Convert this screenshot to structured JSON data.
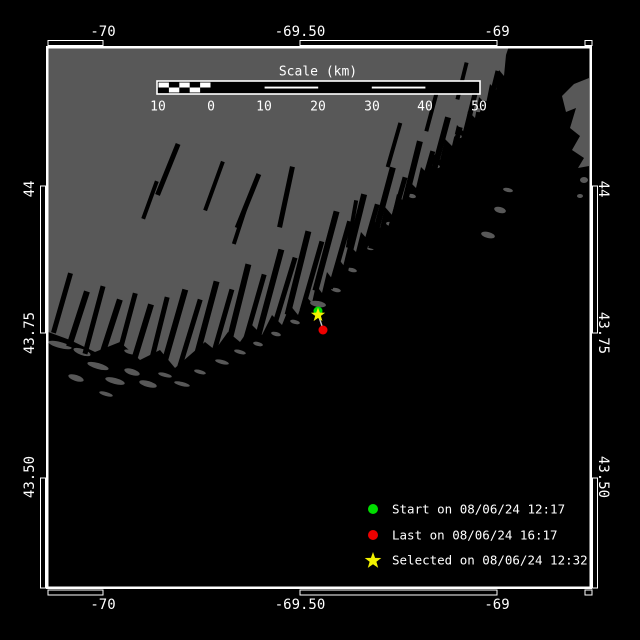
{
  "colors": {
    "background": "#000000",
    "water": "#000000",
    "land": "#585858",
    "frame": "#ffffff",
    "text": "#ffffff",
    "start_marker": "#00dd00",
    "last_marker": "#ee0000",
    "selected_marker": "#f2f200",
    "track": "#c8c8c8"
  },
  "axes": {
    "top": [
      "-70",
      "-69.50",
      "-69"
    ],
    "bottom": [
      "-70",
      "-69.50",
      "-69"
    ],
    "left": [
      "44",
      "43.75",
      "43.50"
    ],
    "right": [
      "44",
      "43.75",
      "43.50"
    ]
  },
  "scale_bar": {
    "title": "Scale (km)",
    "tick_labels": [
      "10",
      "0",
      "10",
      "20",
      "30",
      "40",
      "50"
    ]
  },
  "legend": {
    "items": [
      {
        "marker": "circle",
        "color": "#00dd00",
        "label": "Start on 08/06/24 12:17"
      },
      {
        "marker": "circle",
        "color": "#ee0000",
        "label": "Last on 08/06/24 16:17"
      },
      {
        "marker": "star",
        "color": "#f2f200",
        "label": "Selected on 08/06/24 12:32"
      }
    ]
  },
  "markers": {
    "start": {
      "label": "Start on 08/06/24 12:17"
    },
    "last": {
      "label": "Last on 08/06/24 16:17"
    },
    "selected": {
      "label": "Selected on 08/06/24 12:32"
    }
  }
}
